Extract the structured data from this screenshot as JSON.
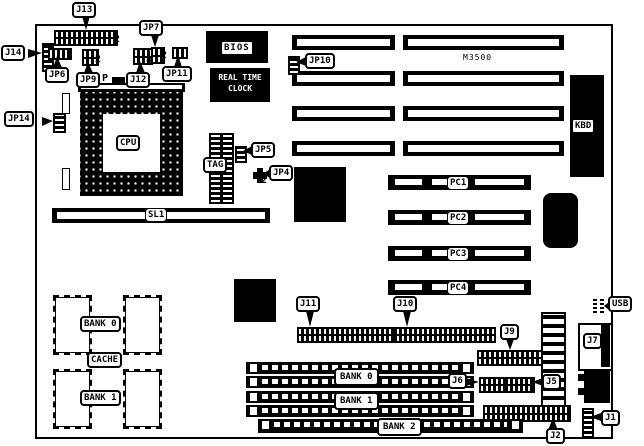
{
  "diagram_title": "M3500 motherboard component location diagram",
  "board_model": "M3500",
  "labels": {
    "j13": "J13",
    "j14": "J14",
    "jp6": "JP6",
    "jp9": "JP9",
    "p_marker": "P",
    "j12": "J12",
    "jp7": "JP7",
    "jp11": "JP11",
    "jp14": "JP14",
    "jp10": "JP10",
    "jp5": "JP5",
    "jp4": "JP4",
    "tag": "TAG",
    "cpu": "CPU",
    "sl1": "SL1",
    "bios": "BIOS",
    "rtc_line1": "REAL TIME",
    "rtc_line2": "CLOCK",
    "m3500": "M3500",
    "kbd": "KBD",
    "pc1": "PC1",
    "pc2": "PC2",
    "pc3": "PC3",
    "pc4": "PC4",
    "cache_bank0": "BANK 0",
    "cache": "CACHE",
    "cache_bank1": "BANK 1",
    "j11": "J11",
    "j10": "J10",
    "j9": "J9",
    "j6": "J6",
    "j5": "J5",
    "j7": "J7",
    "usb": "USB",
    "j1": "J1",
    "j2": "J2",
    "simm_bank0": "BANK 0",
    "simm_bank1": "BANK 1",
    "simm_bank2": "BANK 2"
  },
  "pin_numbers": {
    "j13_pin2": "2",
    "jp9_pin2": "2",
    "j12_pin4": "4",
    "jp7_pin2": "2",
    "jp4_pin2": "2"
  }
}
